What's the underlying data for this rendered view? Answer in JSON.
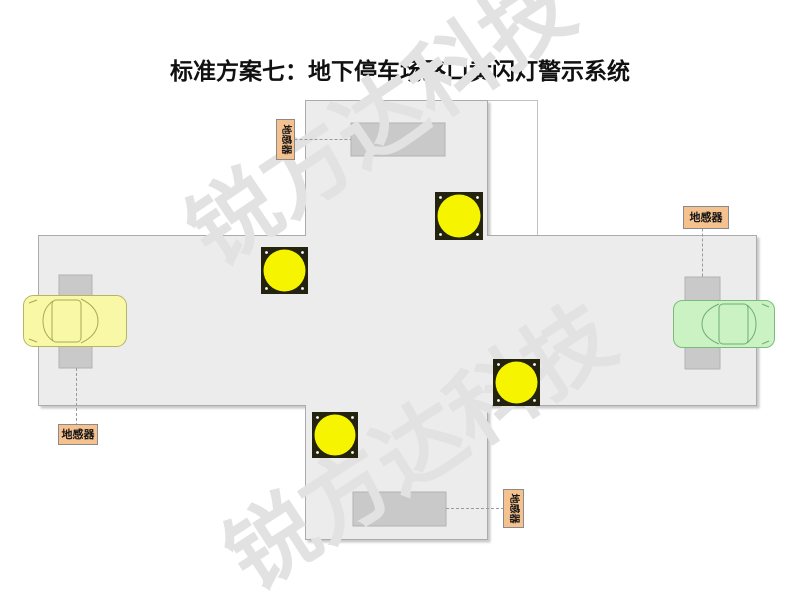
{
  "title": "标准方案七：地下停车场路口黄闪灯警示系统",
  "watermark": {
    "text": "锐方达科技",
    "color": "#e2e2e2"
  },
  "sensor_labels": {
    "top": "地感器",
    "left": "地感器",
    "right": "地感器",
    "bottom": "地感器"
  },
  "legend": {
    "flash_light_count": "4",
    "ground_sensor_count": "4",
    "car_count": "2"
  },
  "colors": {
    "road_fill": "#ececec",
    "road_border": "#ababab",
    "background": "#ffffff",
    "sensor_fill": "#c9c9c9",
    "light_plate": "#23230f",
    "light_lens": "#f7f400",
    "light_screw": "#ffffff",
    "label_fill": "#f5c28f",
    "label_border": "#8a8a8a",
    "car_left_fill": "#f8f8a6",
    "car_left_stroke": "#b5b566",
    "car_right_fill": "#caf2c3",
    "car_right_stroke": "#7cbb7c"
  }
}
